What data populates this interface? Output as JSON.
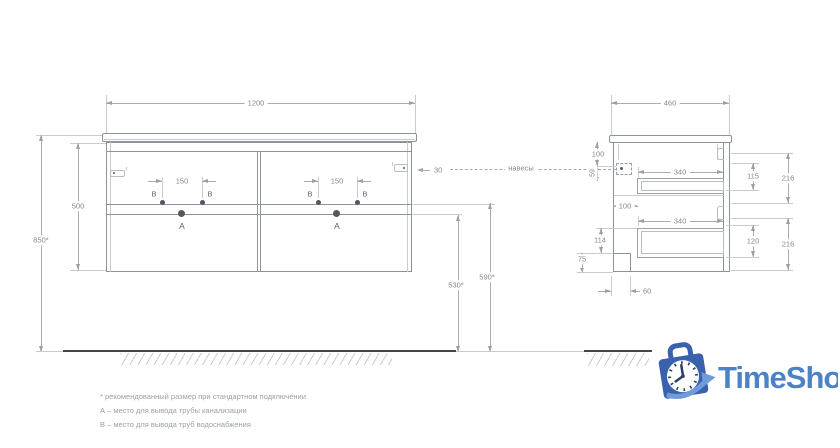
{
  "drawing_type": "vanity-cabinet-technical-drawing",
  "front": {
    "width": "1200",
    "height": "500",
    "mount_height": "850*",
    "supply_height": "590*",
    "drain_height": "530*",
    "supply_span_left": "150",
    "supply_span_right": "150",
    "edge_offset": "30",
    "drain_label": "A",
    "supply_label": "B"
  },
  "side": {
    "depth": "460",
    "hanger_offset_top": "100",
    "hanger_offset_bottom": "59",
    "drawer_depth_top": "340",
    "drawer_depth_bottom": "340",
    "back_clearance": "100",
    "bottom_offset": "114",
    "notch_height": "75",
    "notch_depth": "60",
    "drawer_inner_height_top": "115",
    "front_height_top": "216",
    "drawer_inner_height_bottom": "120",
    "front_height_bottom": "216"
  },
  "hangers_label": "навесы",
  "footnotes": {
    "asterisk": "* рекомендованный размер при стандартном подключении",
    "a": "А – место для вывода трубы канализации",
    "b": "В – место для вывода труб водоснабжения"
  },
  "logo": {
    "text": "TimeShop",
    "text_color": "#4b83c6",
    "bag_color": "#3a62ac",
    "swoosh_color": "#6f9cd9"
  }
}
